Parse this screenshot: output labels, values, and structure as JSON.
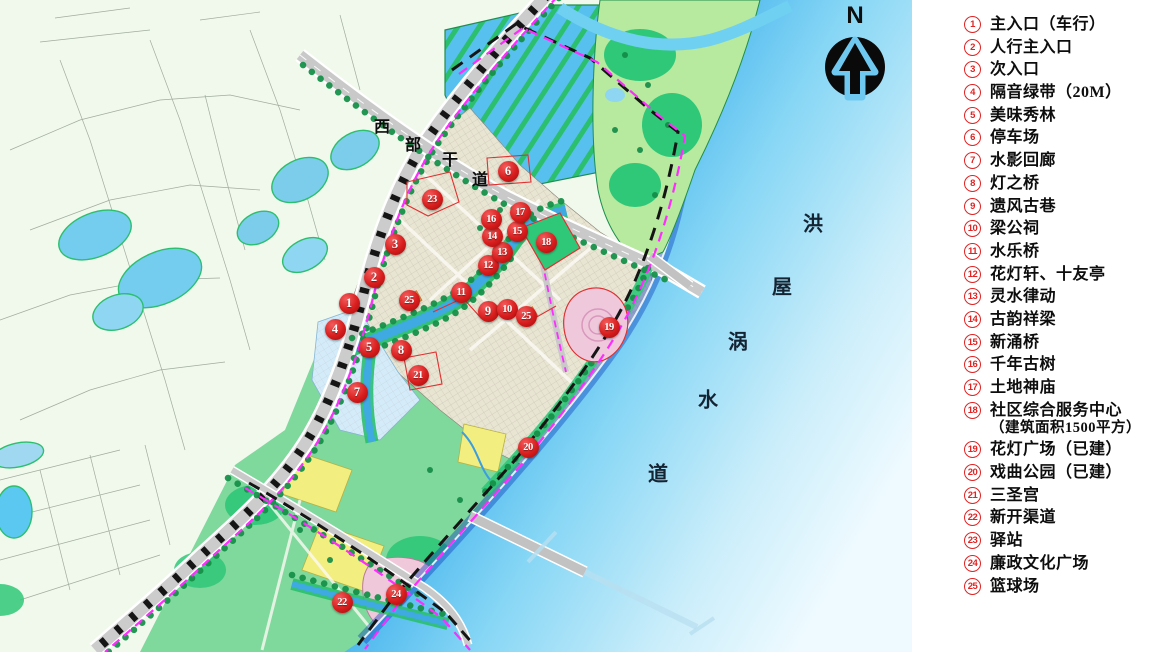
{
  "legend": {
    "items": [
      {
        "num": "1",
        "label": "主入口（车行）"
      },
      {
        "num": "2",
        "label": "人行主入口"
      },
      {
        "num": "3",
        "label": "次入口"
      },
      {
        "num": "4",
        "label": "隔音绿带（20M）"
      },
      {
        "num": "5",
        "label": "美味秀林"
      },
      {
        "num": "6",
        "label": "停车场"
      },
      {
        "num": "7",
        "label": "水影回廊"
      },
      {
        "num": "8",
        "label": "灯之桥"
      },
      {
        "num": "9",
        "label": "遗风古巷"
      },
      {
        "num": "10",
        "label": "梁公祠"
      },
      {
        "num": "11",
        "label": "水乐桥"
      },
      {
        "num": "12",
        "label": "花灯轩、十友亭"
      },
      {
        "num": "13",
        "label": "灵水律动"
      },
      {
        "num": "14",
        "label": "古韵祥梁"
      },
      {
        "num": "15",
        "label": "新涌桥"
      },
      {
        "num": "16",
        "label": "千年古树"
      },
      {
        "num": "17",
        "label": "土地神庙"
      },
      {
        "num": "18",
        "label": "社区综合服务中心",
        "sublabel": "（建筑面积1500平方）"
      },
      {
        "num": "19",
        "label": "花灯广场（已建）"
      },
      {
        "num": "20",
        "label": "戏曲公园（已建）"
      },
      {
        "num": "21",
        "label": "三圣宫"
      },
      {
        "num": "22",
        "label": "新开渠道"
      },
      {
        "num": "23",
        "label": "驿站"
      },
      {
        "num": "24",
        "label": "廉政文化广场"
      },
      {
        "num": "25",
        "label": "篮球场"
      }
    ]
  },
  "map": {
    "north_label": "N",
    "road_label": {
      "text": "西部干道",
      "chars": [
        {
          "ch": "西",
          "x": 382,
          "y": 125
        },
        {
          "ch": "部",
          "x": 413,
          "y": 143
        },
        {
          "ch": "干",
          "x": 450,
          "y": 158
        },
        {
          "ch": "道",
          "x": 480,
          "y": 178
        }
      ]
    },
    "river_label": {
      "text": "洪屋涡水道",
      "chars": [
        {
          "ch": "洪",
          "x": 813,
          "y": 222
        },
        {
          "ch": "屋",
          "x": 782,
          "y": 285
        },
        {
          "ch": "涡",
          "x": 738,
          "y": 340
        },
        {
          "ch": "水",
          "x": 708,
          "y": 398
        },
        {
          "ch": "道",
          "x": 658,
          "y": 472
        }
      ]
    },
    "markers": [
      {
        "n": "1",
        "x": 349,
        "y": 303
      },
      {
        "n": "2",
        "x": 374,
        "y": 277
      },
      {
        "n": "3",
        "x": 395,
        "y": 244
      },
      {
        "n": "4",
        "x": 335,
        "y": 329
      },
      {
        "n": "5",
        "x": 369,
        "y": 347
      },
      {
        "n": "6",
        "x": 508,
        "y": 171
      },
      {
        "n": "7",
        "x": 357,
        "y": 392
      },
      {
        "n": "8",
        "x": 401,
        "y": 350
      },
      {
        "n": "9",
        "x": 488,
        "y": 311
      },
      {
        "n": "10",
        "x": 507,
        "y": 309
      },
      {
        "n": "11",
        "x": 461,
        "y": 292
      },
      {
        "n": "12",
        "x": 488,
        "y": 265
      },
      {
        "n": "13",
        "x": 502,
        "y": 252
      },
      {
        "n": "14",
        "x": 492,
        "y": 236
      },
      {
        "n": "15",
        "x": 517,
        "y": 231
      },
      {
        "n": "16",
        "x": 491,
        "y": 219
      },
      {
        "n": "17",
        "x": 520,
        "y": 212
      },
      {
        "n": "18",
        "x": 546,
        "y": 242
      },
      {
        "n": "19",
        "x": 609,
        "y": 327
      },
      {
        "n": "20",
        "x": 528,
        "y": 447
      },
      {
        "n": "21",
        "x": 418,
        "y": 375
      },
      {
        "n": "22",
        "x": 342,
        "y": 602
      },
      {
        "n": "23",
        "x": 432,
        "y": 199
      },
      {
        "n": "24",
        "x": 396,
        "y": 594
      },
      {
        "n": "25",
        "x": 409,
        "y": 300
      },
      {
        "n": "25",
        "x": 526,
        "y": 316
      }
    ],
    "colors": {
      "marker_red": "#d81d1d",
      "legend_red": "#e02424",
      "boundary_magenta": "#ff2bff",
      "water_deep": "#0a49cc",
      "water_pale": "#eefaff",
      "vegetation_green": "#2fc878",
      "village_beige": "#e9e5d3"
    }
  }
}
